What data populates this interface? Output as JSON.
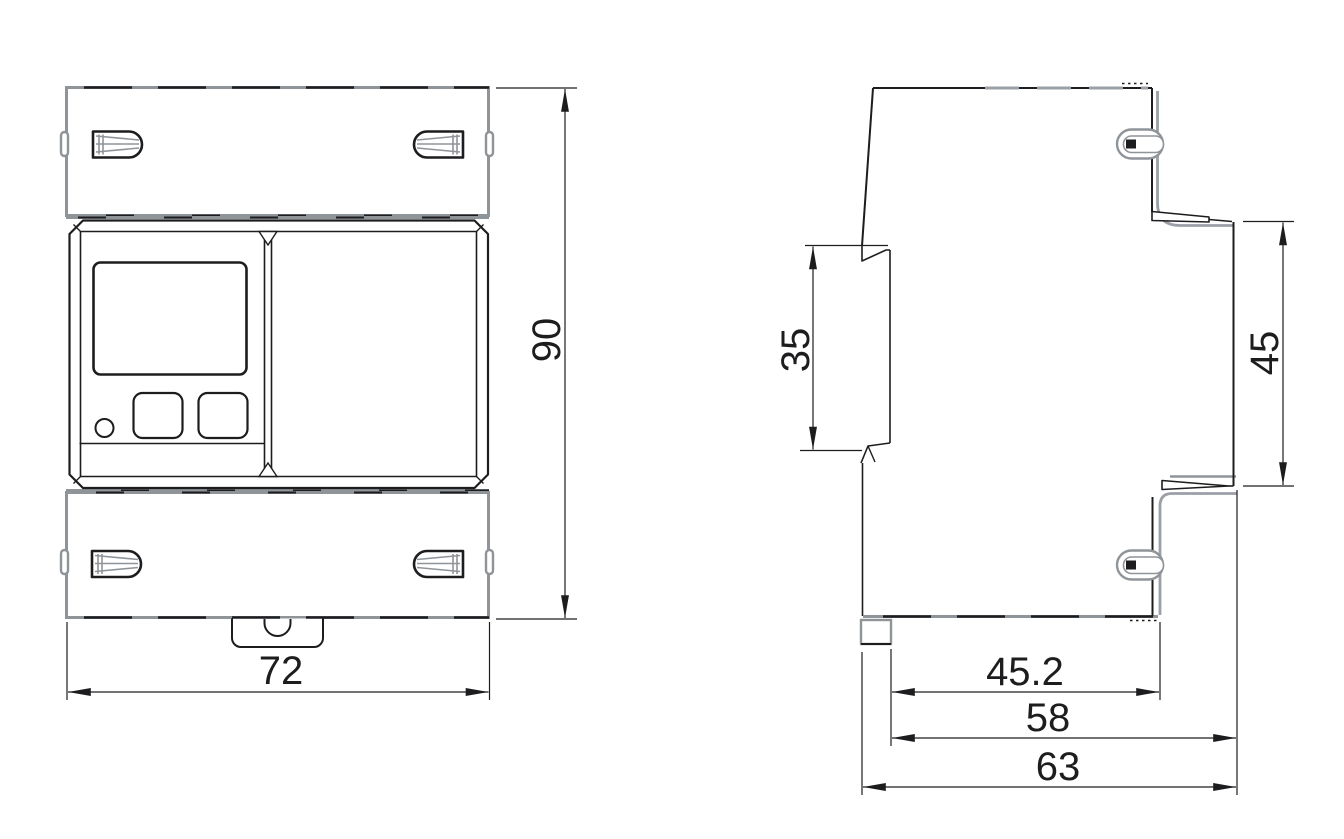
{
  "drawing": {
    "front_view": {
      "width_dim": "72",
      "height_dim": "90"
    },
    "side_view": {
      "rail_slot_dim": "35",
      "panel_height_dim": "45",
      "depth_to_body_dim": "45.2",
      "depth_to_panel_dim": "58",
      "overall_depth_dim": "63"
    },
    "colors": {
      "line": "#1d1d1f",
      "cover_outline": "#8f9499",
      "background": "#ffffff"
    }
  }
}
